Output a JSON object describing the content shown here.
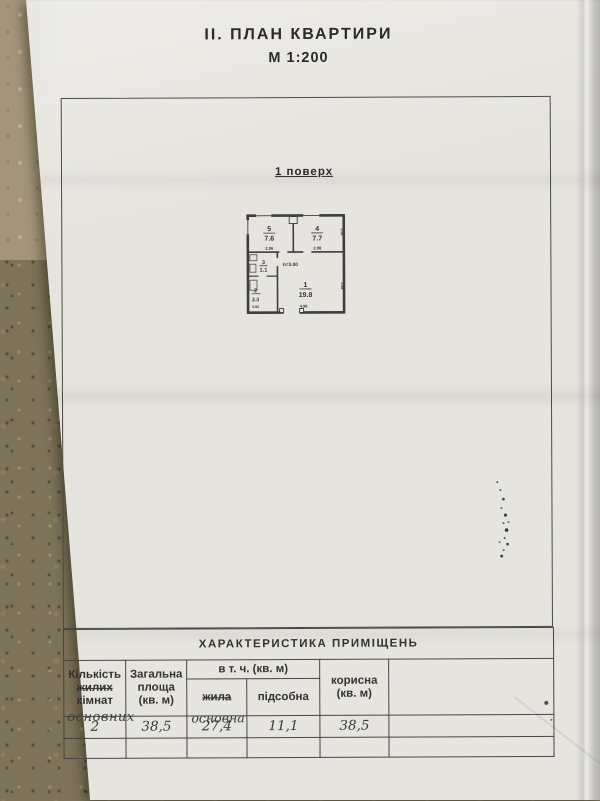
{
  "page": {
    "title": "ІІ. ПЛАН  КВАРТИРИ",
    "scale": "М 1:200",
    "floor_label": "1 поверх"
  },
  "floor_plan": {
    "height_label": "h=3.00",
    "rooms": [
      {
        "number": "5",
        "area": "7.6",
        "width_dim": "2.96"
      },
      {
        "number": "4",
        "area": "7.7",
        "width_dim": "2.98",
        "depth_dim": "2.58"
      },
      {
        "number": "3",
        "area": "1.1"
      },
      {
        "number": "2",
        "area": "2.3",
        "width_dim": "0.93"
      },
      {
        "number": "1",
        "area": "19.8",
        "width_dim": "4.98",
        "depth_dim": "3.98"
      }
    ]
  },
  "table": {
    "title": "ХАРАКТЕРИСТИКА  ПРИМІЩЕНЬ",
    "col_rooms_line1": "Кількість",
    "col_rooms_line2": "жилих",
    "col_rooms_line3": "кімнат",
    "col_rooms_handwritten": "основних",
    "col_total_line1": "Загальна",
    "col_total_line2": "площа",
    "col_total_line3": "(кв. м)",
    "group_incl": "в т. ч. (кв. м)",
    "sub_living": "жила",
    "sub_living_handwritten": "основна",
    "sub_utility": "підсобна",
    "col_useful_line1": "корисна",
    "col_useful_line2": "(кв. м)",
    "values": [
      "2",
      "38,5",
      "27,4",
      "11,1",
      "38,5"
    ]
  }
}
